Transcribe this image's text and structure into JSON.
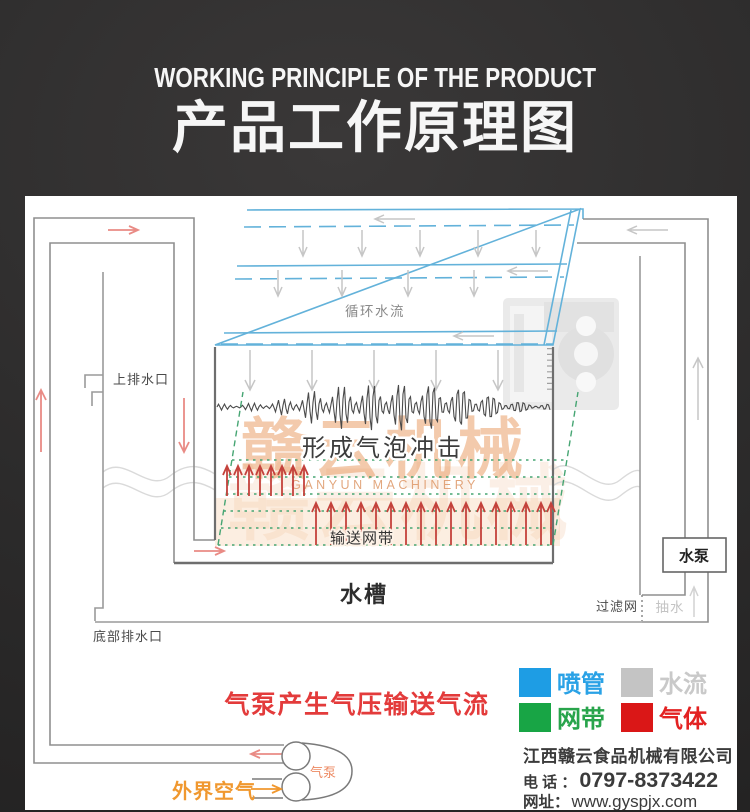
{
  "header": {
    "title_en": "WORKING PRINCIPLE OF THE PRODUCT",
    "title_zh": "产品工作原理图"
  },
  "diagram": {
    "labels": {
      "circulating_water": "循环水流",
      "upper_drain": "上排水口",
      "bubble_impact": "形成气泡冲击",
      "conveyor_belt": "输送网带",
      "water_tank": "水槽",
      "water_pump": "水泵",
      "filter_screen": "过滤网",
      "suction": "抽水",
      "bottom_drain": "底部排水口",
      "air_caption": "气泵产生气压输送气流",
      "outside_air": "外界空气",
      "air_pump": "气泵"
    },
    "watermark": {
      "text": "赣云机械",
      "subtext": "GANYUN MACHINERY"
    }
  },
  "legend": {
    "items": [
      {
        "label": "喷管",
        "color": "#1e9de4",
        "text_color": "#2aa2e6"
      },
      {
        "label": "水流",
        "color": "#c4c4c4",
        "text_color": "#c9c9c9"
      },
      {
        "label": "网带",
        "color": "#18a545",
        "text_color": "#28a44b"
      },
      {
        "label": "气体",
        "color": "#da1717",
        "text_color": "#e32222"
      }
    ]
  },
  "company": {
    "name": "江西赣云食品机械有限公司",
    "phone_label": "电 话 ：",
    "phone": "0797-8373422",
    "web_label": "网址：",
    "website": "www.gyspjx.com"
  },
  "colors": {
    "air_flow": "#e98b85",
    "bubbles": "#c4423c",
    "water_arrows": "#c6c6c6",
    "spray_blue": "#63b2da",
    "belt_green": "#46a573",
    "caption_red": "#e33b3b",
    "outside_air_orange": "#f0982f",
    "watermark_orange": "#e8965c"
  }
}
